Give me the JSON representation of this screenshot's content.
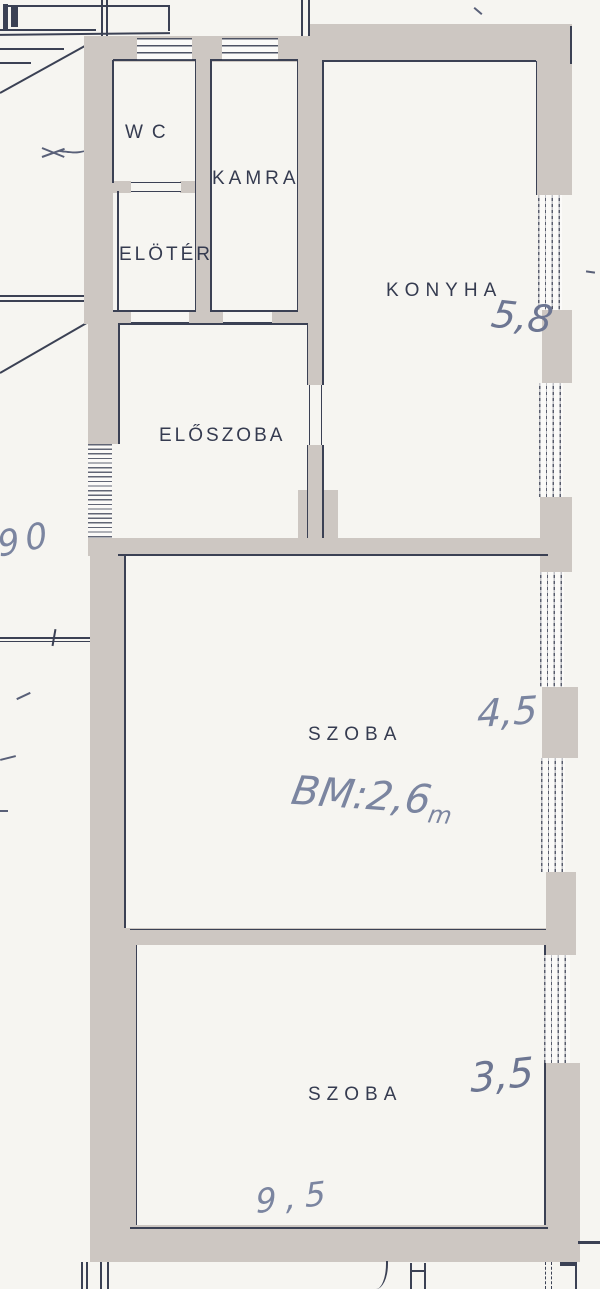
{
  "rooms": [
    {
      "name": "wc",
      "label": "WC"
    },
    {
      "name": "kamra",
      "label": "KAMRA"
    },
    {
      "name": "eloter",
      "label": "ELÖTÉR"
    },
    {
      "name": "konyha",
      "label": "KONYHA"
    },
    {
      "name": "eloszoba",
      "label": "ELŐSZOBA"
    },
    {
      "name": "szoba-middle",
      "label": "SZOBA"
    },
    {
      "name": "szoba-bottom",
      "label": "SZOBA"
    }
  ],
  "measurements": [
    {
      "name": "konyha-width",
      "value": "5,8"
    },
    {
      "name": "szoba-middle-width",
      "value": "4,5"
    },
    {
      "name": "inner-height",
      "value": "BM:2,6"
    },
    {
      "name": "inner-height-unit",
      "value": "m"
    },
    {
      "name": "szoba-bottom-width",
      "value": "3,5"
    },
    {
      "name": "szoba-bottom-length",
      "value": "9,5"
    },
    {
      "name": "stairwell-number",
      "value": "90"
    }
  ],
  "icons": {
    "stair_arrow": "left-arrow"
  },
  "colors": {
    "wall": "#cdc7c2",
    "line": "#3b4154",
    "handwriting": "#7b85a0",
    "paper": "#f6f5f1"
  }
}
